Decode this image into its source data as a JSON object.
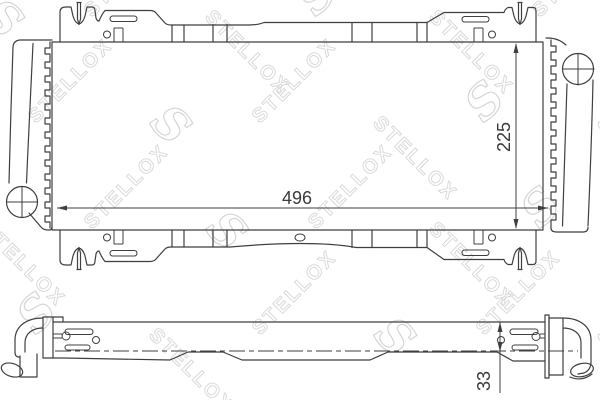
{
  "drawing": {
    "type": "technical-drawing",
    "part": "radiator",
    "dimensions": {
      "width": "496",
      "height": "225",
      "thickness": "33"
    },
    "watermark": {
      "text": "STELLOX",
      "logo": "S",
      "color": "#dadada"
    },
    "colors": {
      "line": "#3f3f3f",
      "background": "#ffffff",
      "dimension_text": "#3a3a3a"
    }
  }
}
